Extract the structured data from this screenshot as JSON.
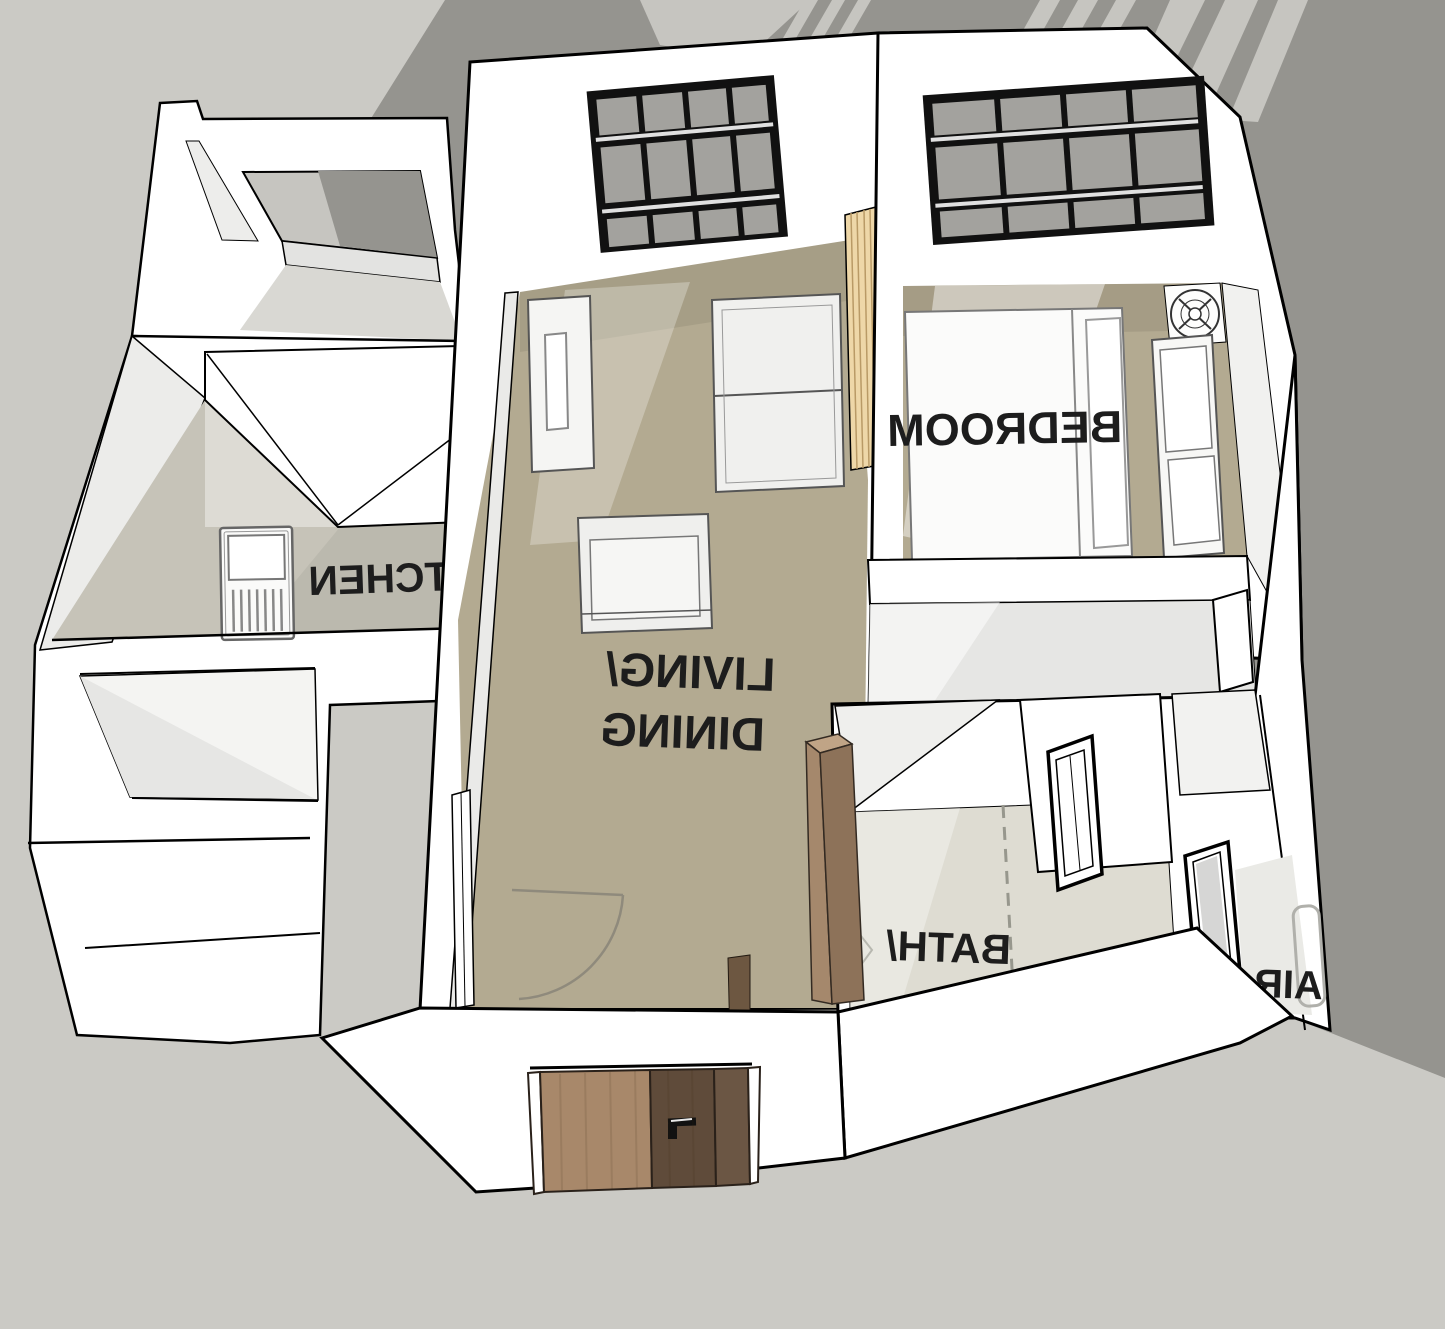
{
  "scene": {
    "type": "3d-isometric-floor-plan",
    "style": "sketchup-white-model",
    "view": "one-bedroom apartment seen from above/front; floor labels appear mirrored"
  },
  "rooms": [
    {
      "id": "kitchen",
      "label": "KITCHEN",
      "floor_color": "#c6c3b8",
      "label_mirrored": true
    },
    {
      "id": "living-dining",
      "label_line1": "LIVING/",
      "label_line2": "DINING",
      "floor_color": "#b3aa91",
      "label_mirrored": true
    },
    {
      "id": "bedroom",
      "label": "BEDROOM",
      "floor_color": "#b3aa91",
      "label_mirrored": true
    },
    {
      "id": "bath-wc",
      "label_line1": "BATH/",
      "label_line2": "WC",
      "floor_color": "#dedcd2",
      "label_mirrored": true
    },
    {
      "id": "utility-closet",
      "label": "AIR",
      "label_partial": true,
      "floor_color": "#eaeae6",
      "label_mirrored": true
    }
  ],
  "objects": {
    "entry_door": {
      "panel_colors": [
        "#a8886a",
        "#5f4b3a",
        "#6b5644"
      ],
      "handle": "black lever handle"
    },
    "windows": {
      "style": "dark gridded window, 4 columns x 3 rows",
      "frame_color": "#111111",
      "glass_color": "#a3a29e",
      "count_large": 2,
      "count_small": 2
    },
    "furniture": [
      "kitchen stove",
      "kitchen counters",
      "sideboard",
      "sofa",
      "armchair with table",
      "bed with pillow",
      "wardrobe",
      "bath cabinet",
      "radiator"
    ],
    "symbols": [
      "ceiling-fan-icon",
      "door-swing-arc",
      "dashed-partition-line",
      "accordion-door"
    ]
  },
  "colors": {
    "background": "#cbcac5",
    "cast_shadow": "#95948f",
    "shadow_light_stripes": "#c6c5c0",
    "walls": "#ffffff",
    "outlines": "#000000",
    "floor_tan": "#b3aa91",
    "floor_kitchen": "#c6c3b8",
    "floor_bath": "#dedcd2",
    "corridor_floor": "#e6e6e4",
    "accordion_door": "#eed7a8",
    "label_text": "#1d1d1d"
  }
}
